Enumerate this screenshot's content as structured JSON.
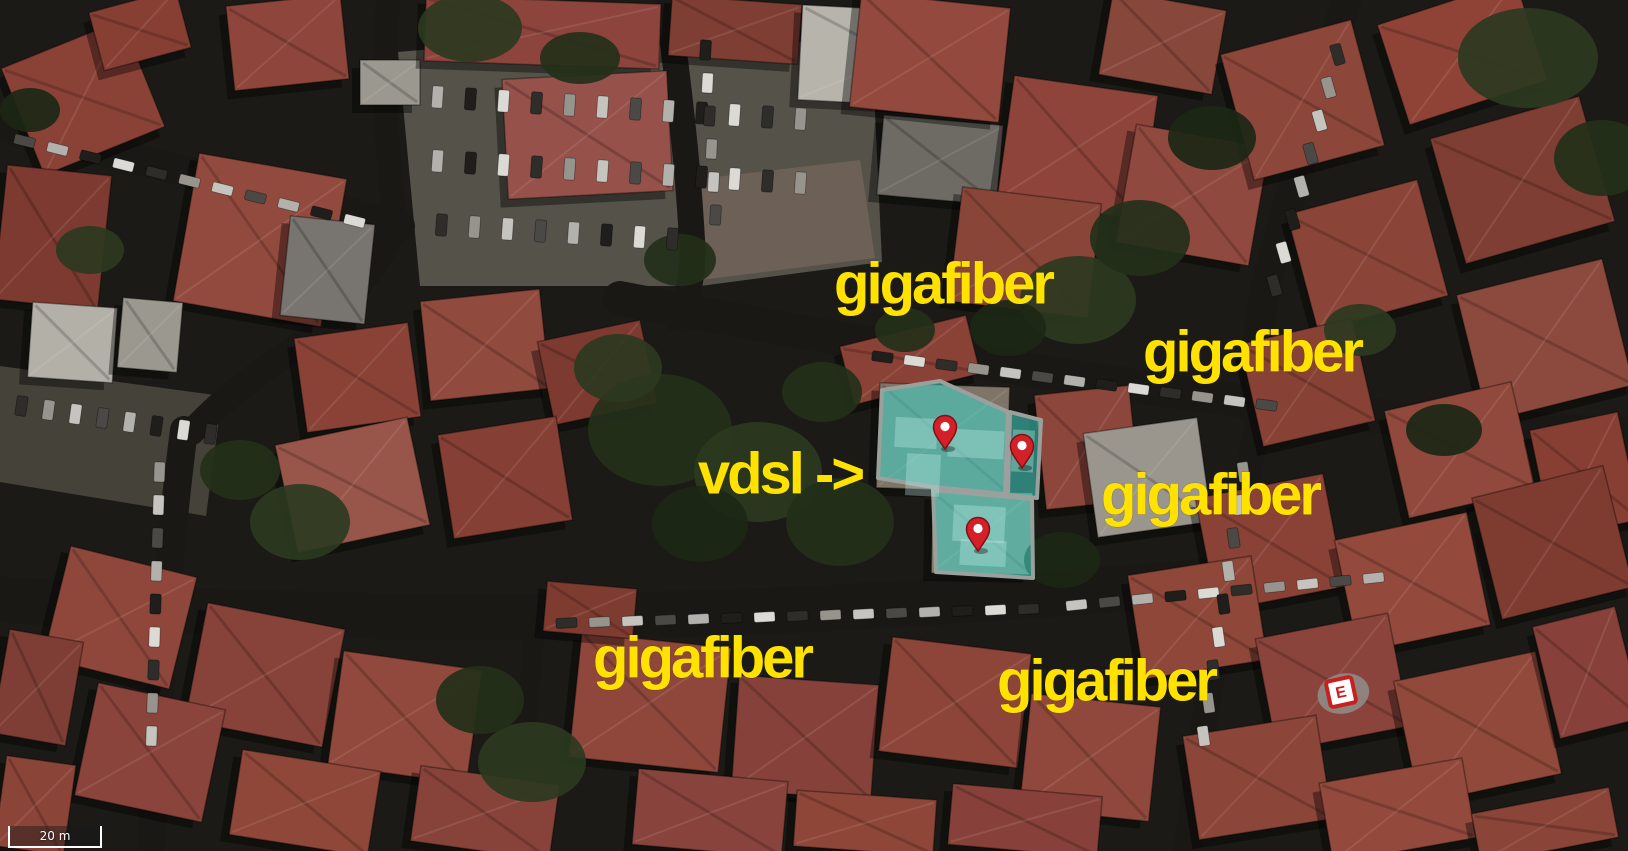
{
  "map": {
    "annotation_style": {
      "color": "#ffe200",
      "font_px": 58,
      "letter_spacing": -3
    },
    "annotations": [
      {
        "id": "gigafiber-1",
        "text": "gigafiber",
        "x": 943,
        "y": 284
      },
      {
        "id": "gigafiber-2",
        "text": "gigafiber",
        "x": 1252,
        "y": 352
      },
      {
        "id": "gigafiber-3",
        "text": "gigafiber",
        "x": 1210,
        "y": 495
      },
      {
        "id": "vdsl-arrow",
        "text": "vdsl ->",
        "x": 780,
        "y": 474
      },
      {
        "id": "gigafiber-4",
        "text": "gigafiber",
        "x": 702,
        "y": 658
      },
      {
        "id": "gigafiber-5",
        "text": "gigafiber",
        "x": 1106,
        "y": 681
      }
    ],
    "pins": [
      {
        "x": 945,
        "y": 428
      },
      {
        "x": 1022,
        "y": 447
      },
      {
        "x": 978,
        "y": 530
      }
    ],
    "pin_colors": {
      "body": "#d42028",
      "border": "#7e1114",
      "dot": "#ffffff"
    },
    "highlight": {
      "fill": "#3fd6c8",
      "fill_opacity": 0.55,
      "stroke": "#9aa19d",
      "stroke_width": 4,
      "polygons": [
        [
          [
            882,
            390
          ],
          [
            940,
            381
          ],
          [
            1008,
            412
          ],
          [
            1005,
            494
          ],
          [
            933,
            487
          ],
          [
            878,
            478
          ]
        ],
        [
          [
            1010,
            412
          ],
          [
            1041,
            420
          ],
          [
            1037,
            498
          ],
          [
            1008,
            495
          ]
        ],
        [
          [
            933,
            490
          ],
          [
            1032,
            499
          ],
          [
            1033,
            578
          ],
          [
            936,
            572
          ]
        ]
      ],
      "inner_patches": [
        [
          895,
          418,
          42,
          30
        ],
        [
          948,
          430,
          56,
          28
        ],
        [
          906,
          454,
          34,
          42
        ],
        [
          953,
          506,
          52,
          36
        ],
        [
          1012,
          430,
          22,
          42
        ],
        [
          960,
          540,
          46,
          26
        ]
      ]
    },
    "rooftop_sign": {
      "letter": "E",
      "x": 1341,
      "y": 692,
      "rot": -12,
      "box": "#ffffff",
      "mark": "#c8201f"
    },
    "scale_bar": {
      "label": "20 m"
    },
    "basemap": {
      "background": "#1b1a16",
      "street_color": "#191814",
      "streets": [
        {
          "d": "M -20 598 Q 400 630 830 608 Q 1200 588 1648 538",
          "w": 46
        },
        {
          "d": "M 620 298 Q 980 368 1300 408 Q 1480 428 1648 436",
          "w": 34
        },
        {
          "d": "M 1352 -20 Q 1306 140 1270 270 Q 1252 340 1258 420",
          "w": 30
        },
        {
          "d": "M 664 -20 Q 686 130 692 240 Q 695 290 676 318",
          "w": 26
        },
        {
          "d": "M -20 122 Q 180 168 400 226",
          "w": 30
        },
        {
          "d": "M 390 -20 Q 378 100 396 224",
          "w": 24
        },
        {
          "d": "M 398 224 Q 352 310 290 352 Q 225 395 192 432",
          "w": 26
        },
        {
          "d": "M 184 430 Q 162 600 150 870",
          "w": 28
        },
        {
          "d": "M 1258 428 Q 1218 600 1184 870",
          "w": 26
        },
        {
          "d": "M 536 612 Q 526 730 512 870",
          "w": 20
        }
      ],
      "parking_lots": [
        {
          "points": [
            [
              398,
              52
            ],
            [
              652,
              30
            ],
            [
              872,
              48
            ],
            [
              882,
              262
            ],
            [
              700,
              286
            ],
            [
              420,
              286
            ]
          ],
          "fill": "#55524a"
        },
        {
          "points": [
            [
              690,
              180
            ],
            [
              860,
              160
            ],
            [
              875,
              258
            ],
            [
              700,
              280
            ]
          ],
          "fill": "#6d6157"
        },
        {
          "points": [
            [
              0,
              366
            ],
            [
              222,
              396
            ],
            [
              206,
              516
            ],
            [
              0,
              482
            ]
          ],
          "fill": "#454239"
        }
      ],
      "buildings": [
        [
          18,
          40,
          130,
          115,
          -22,
          "#8a4237"
        ],
        [
          0,
          170,
          105,
          135,
          6,
          "#7c3a30"
        ],
        [
          185,
          165,
          150,
          150,
          10,
          "#934a3e"
        ],
        [
          230,
          0,
          115,
          85,
          -6,
          "#8e453b"
        ],
        [
          95,
          0,
          90,
          60,
          -15,
          "#873f33"
        ],
        [
          30,
          305,
          85,
          75,
          4,
          "#b3b0a8"
        ],
        [
          285,
          220,
          85,
          100,
          6,
          "#787570"
        ],
        [
          360,
          60,
          60,
          45,
          0,
          "#9b988f"
        ],
        [
          425,
          0,
          235,
          65,
          2,
          "#8c443c"
        ],
        [
          505,
          75,
          165,
          120,
          -3,
          "#95514a"
        ],
        [
          670,
          0,
          130,
          60,
          4,
          "#7f3e34"
        ],
        [
          800,
          10,
          200,
          95,
          3,
          "#b7b4ac"
        ],
        [
          880,
          120,
          120,
          80,
          5,
          "#6e6b64"
        ],
        [
          300,
          330,
          115,
          95,
          -8,
          "#8a4237"
        ],
        [
          425,
          295,
          120,
          100,
          -6,
          "#914a3e"
        ],
        [
          545,
          330,
          105,
          85,
          -12,
          "#7c3a30"
        ],
        [
          285,
          430,
          135,
          110,
          -12,
          "#98564a"
        ],
        [
          445,
          425,
          120,
          105,
          -9,
          "#853f34"
        ],
        [
          845,
          330,
          130,
          60,
          -14,
          "#8a4136"
        ],
        [
          1040,
          390,
          95,
          115,
          -6,
          "#8d463b"
        ],
        [
          855,
          0,
          150,
          115,
          6,
          "#93493d"
        ],
        [
          1005,
          85,
          145,
          125,
          8,
          "#8e443a"
        ],
        [
          1105,
          0,
          115,
          85,
          10,
          "#87473b"
        ],
        [
          955,
          195,
          140,
          115,
          7,
          "#8a4539"
        ],
        [
          1125,
          135,
          135,
          120,
          10,
          "#90493e"
        ],
        [
          1235,
          35,
          135,
          130,
          -15,
          "#8c463a"
        ],
        [
          1390,
          0,
          145,
          105,
          -18,
          "#8f4337"
        ],
        [
          1445,
          115,
          155,
          130,
          -16,
          "#7f3e33"
        ],
        [
          1300,
          195,
          135,
          120,
          -15,
          "#8b4438"
        ],
        [
          1470,
          275,
          150,
          130,
          -14,
          "#8c4a3e"
        ],
        [
          1250,
          330,
          115,
          105,
          -13,
          "#874135"
        ],
        [
          1395,
          395,
          130,
          110,
          -13,
          "#90493c"
        ],
        [
          1540,
          420,
          90,
          110,
          -12,
          "#873f33"
        ],
        [
          1090,
          425,
          115,
          105,
          -8,
          "#9a968e"
        ],
        [
          1205,
          485,
          130,
          115,
          -11,
          "#8a4136"
        ],
        [
          1345,
          525,
          135,
          115,
          -12,
          "#93493c"
        ],
        [
          1485,
          480,
          135,
          125,
          -14,
          "#7e3c31"
        ],
        [
          1135,
          565,
          125,
          105,
          -9,
          "#8f473a"
        ],
        [
          1265,
          625,
          135,
          115,
          -11,
          "#8a443c"
        ],
        [
          1405,
          665,
          145,
          125,
          -12,
          "#90493a"
        ],
        [
          1545,
          615,
          85,
          115,
          -14,
          "#87413a"
        ],
        [
          1190,
          725,
          135,
          105,
          -9,
          "#8c4539"
        ],
        [
          1325,
          770,
          145,
          81,
          -10,
          "#93493c"
        ],
        [
          1475,
          800,
          140,
          51,
          -11,
          "#8a4438"
        ],
        [
          575,
          640,
          150,
          125,
          6,
          "#8f473c"
        ],
        [
          735,
          680,
          140,
          115,
          4,
          "#86423a"
        ],
        [
          885,
          645,
          140,
          115,
          7,
          "#8d4539"
        ],
        [
          1025,
          700,
          130,
          115,
          6,
          "#90483c"
        ],
        [
          635,
          775,
          150,
          76,
          5,
          "#88443c"
        ],
        [
          795,
          795,
          140,
          56,
          4,
          "#8e4638"
        ],
        [
          950,
          790,
          150,
          61,
          5,
          "#87413a"
        ],
        [
          545,
          585,
          90,
          50,
          5,
          "#7e3c31"
        ],
        [
          55,
          560,
          130,
          115,
          14,
          "#8f473c"
        ],
        [
          195,
          615,
          140,
          120,
          11,
          "#87433a"
        ],
        [
          335,
          660,
          140,
          115,
          8,
          "#90493c"
        ],
        [
          85,
          695,
          130,
          115,
          12,
          "#8a443c"
        ],
        [
          235,
          760,
          140,
          86,
          9,
          "#8e4739"
        ],
        [
          0,
          635,
          75,
          105,
          10,
          "#7e3e35"
        ],
        [
          415,
          775,
          140,
          76,
          8,
          "#87433a"
        ],
        [
          0,
          760,
          70,
          91,
          8,
          "#8a4438"
        ],
        [
          120,
          300,
          60,
          70,
          5,
          "#9b988f"
        ],
        [
          878,
          385,
          130,
          105,
          2,
          "#7f7468"
        ],
        [
          932,
          492,
          100,
          82,
          1,
          "#887d70"
        ]
      ],
      "tree_colors": [
        "#233019",
        "#2b3a20",
        "#1c2715"
      ],
      "trees": [
        [
          660,
          430,
          72,
          56,
          0
        ],
        [
          758,
          472,
          64,
          50,
          1
        ],
        [
          840,
          522,
          54,
          44,
          0
        ],
        [
          700,
          524,
          48,
          38,
          2
        ],
        [
          618,
          368,
          44,
          34,
          1
        ],
        [
          822,
          392,
          40,
          30,
          0
        ],
        [
          1078,
          300,
          58,
          44,
          1
        ],
        [
          1140,
          238,
          50,
          38,
          0
        ],
        [
          1008,
          328,
          38,
          28,
          2
        ],
        [
          470,
          28,
          52,
          34,
          1
        ],
        [
          580,
          58,
          40,
          26,
          0
        ],
        [
          1528,
          58,
          70,
          50,
          1
        ],
        [
          1602,
          158,
          48,
          38,
          0
        ],
        [
          1212,
          138,
          44,
          32,
          2
        ],
        [
          532,
          762,
          54,
          40,
          1
        ],
        [
          480,
          700,
          44,
          34,
          0
        ],
        [
          1062,
          560,
          38,
          28,
          2
        ],
        [
          300,
          522,
          50,
          38,
          1
        ],
        [
          240,
          470,
          40,
          30,
          0
        ],
        [
          1444,
          430,
          38,
          26,
          2
        ],
        [
          90,
          250,
          34,
          24,
          1
        ],
        [
          680,
          260,
          36,
          26,
          0
        ],
        [
          30,
          110,
          30,
          22,
          2
        ],
        [
          1360,
          330,
          36,
          26,
          1
        ],
        [
          905,
          330,
          30,
          22,
          0
        ]
      ],
      "car_colors": [
        "#dcdad4",
        "#2e2d2a",
        "#97948e",
        "#c6c4be",
        "#4a4945",
        "#b3b1ab",
        "#1f1e1b"
      ],
      "car_rows": [
        {
          "x": 432,
          "y": 86,
          "dx": 33,
          "dy": 2,
          "n": 12,
          "w": 11,
          "h": 22,
          "rot": 4
        },
        {
          "x": 432,
          "y": 150,
          "dx": 33,
          "dy": 2,
          "n": 12,
          "w": 11,
          "h": 22,
          "rot": 4
        },
        {
          "x": 436,
          "y": 214,
          "dx": 33,
          "dy": 2,
          "n": 8,
          "w": 11,
          "h": 22,
          "rot": 4
        },
        {
          "x": 556,
          "y": 618,
          "dx": 33,
          "dy": -1,
          "n": 15,
          "w": 21,
          "h": 10,
          "rot": -3
        },
        {
          "x": 1066,
          "y": 600,
          "dx": 33,
          "dy": -3,
          "n": 10,
          "w": 21,
          "h": 10,
          "rot": -6
        },
        {
          "x": 872,
          "y": 352,
          "dx": 32,
          "dy": 4,
          "n": 13,
          "w": 21,
          "h": 10,
          "rot": 8
        },
        {
          "x": 14,
          "y": 136,
          "dx": 33,
          "dy": 8,
          "n": 11,
          "w": 21,
          "h": 10,
          "rot": 14
        },
        {
          "x": 1332,
          "y": 44,
          "dx": -9,
          "dy": 33,
          "n": 8,
          "w": 11,
          "h": 21,
          "rot": -16
        },
        {
          "x": 16,
          "y": 396,
          "dx": 27,
          "dy": 4,
          "n": 8,
          "w": 11,
          "h": 20,
          "rot": 8
        },
        {
          "x": 154,
          "y": 462,
          "dx": -1,
          "dy": 33,
          "n": 9,
          "w": 11,
          "h": 20,
          "rot": 2
        },
        {
          "x": 1238,
          "y": 462,
          "dx": -5,
          "dy": 33,
          "n": 9,
          "w": 11,
          "h": 20,
          "rot": -8
        },
        {
          "x": 700,
          "y": 40,
          "dx": 2,
          "dy": 33,
          "n": 6,
          "w": 11,
          "h": 20,
          "rot": 3
        }
      ]
    }
  }
}
